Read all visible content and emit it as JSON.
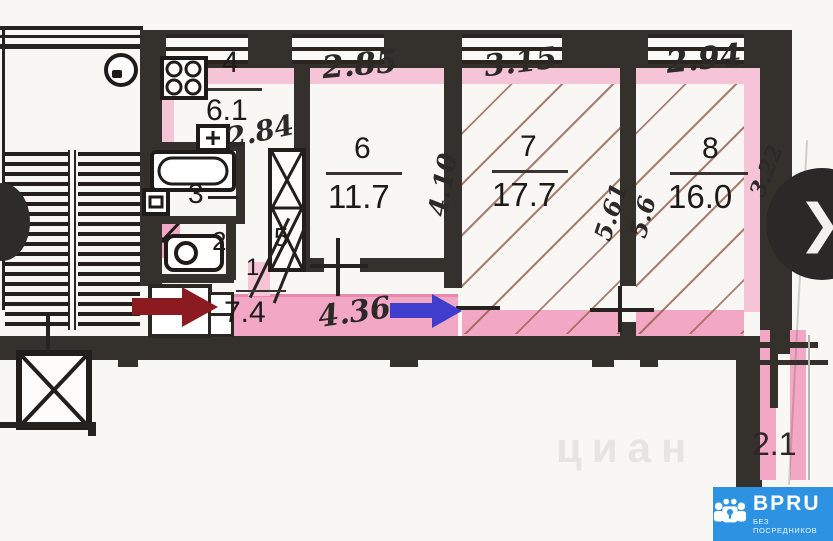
{
  "plan": {
    "rooms": {
      "kitchen": {
        "number": "4",
        "area": "6.1"
      },
      "room6": {
        "number": "6",
        "area": "11.7"
      },
      "room7": {
        "number": "7",
        "area": "17.7"
      },
      "room8": {
        "number": "8",
        "area": "16.0"
      },
      "bathroom": {
        "number": "3"
      },
      "wc": {
        "number": "2"
      },
      "closet": {
        "number": "5"
      },
      "hallway": {
        "number": "1",
        "area": "7.4"
      },
      "balcony": {
        "area": "2.1"
      }
    },
    "dimensions": {
      "kitchen_width": "2.84",
      "room6_width": "2.85",
      "room6_depth": "4.10",
      "room7_width": "3.15",
      "room7_depth": "5.61",
      "room8_depth": "5.6",
      "room8_width": "2.94",
      "room8_side": "3.22",
      "hallway_length": "4.36"
    }
  },
  "viewer": {
    "next_chevron": "❯"
  },
  "brand": {
    "name": "BPRU",
    "tagline": "БЕЗ ПОСРЕДНИКОВ"
  },
  "watermark": {
    "text": "циан"
  },
  "colors": {
    "highlight_pink": "#f2a8c4",
    "wall_dark": "#34302b",
    "hatch_brown": "#96604f",
    "red_arrow": "#8c1b21",
    "blue_arrow": "#3f3dcb",
    "brand_blue": "#2e92e2"
  }
}
